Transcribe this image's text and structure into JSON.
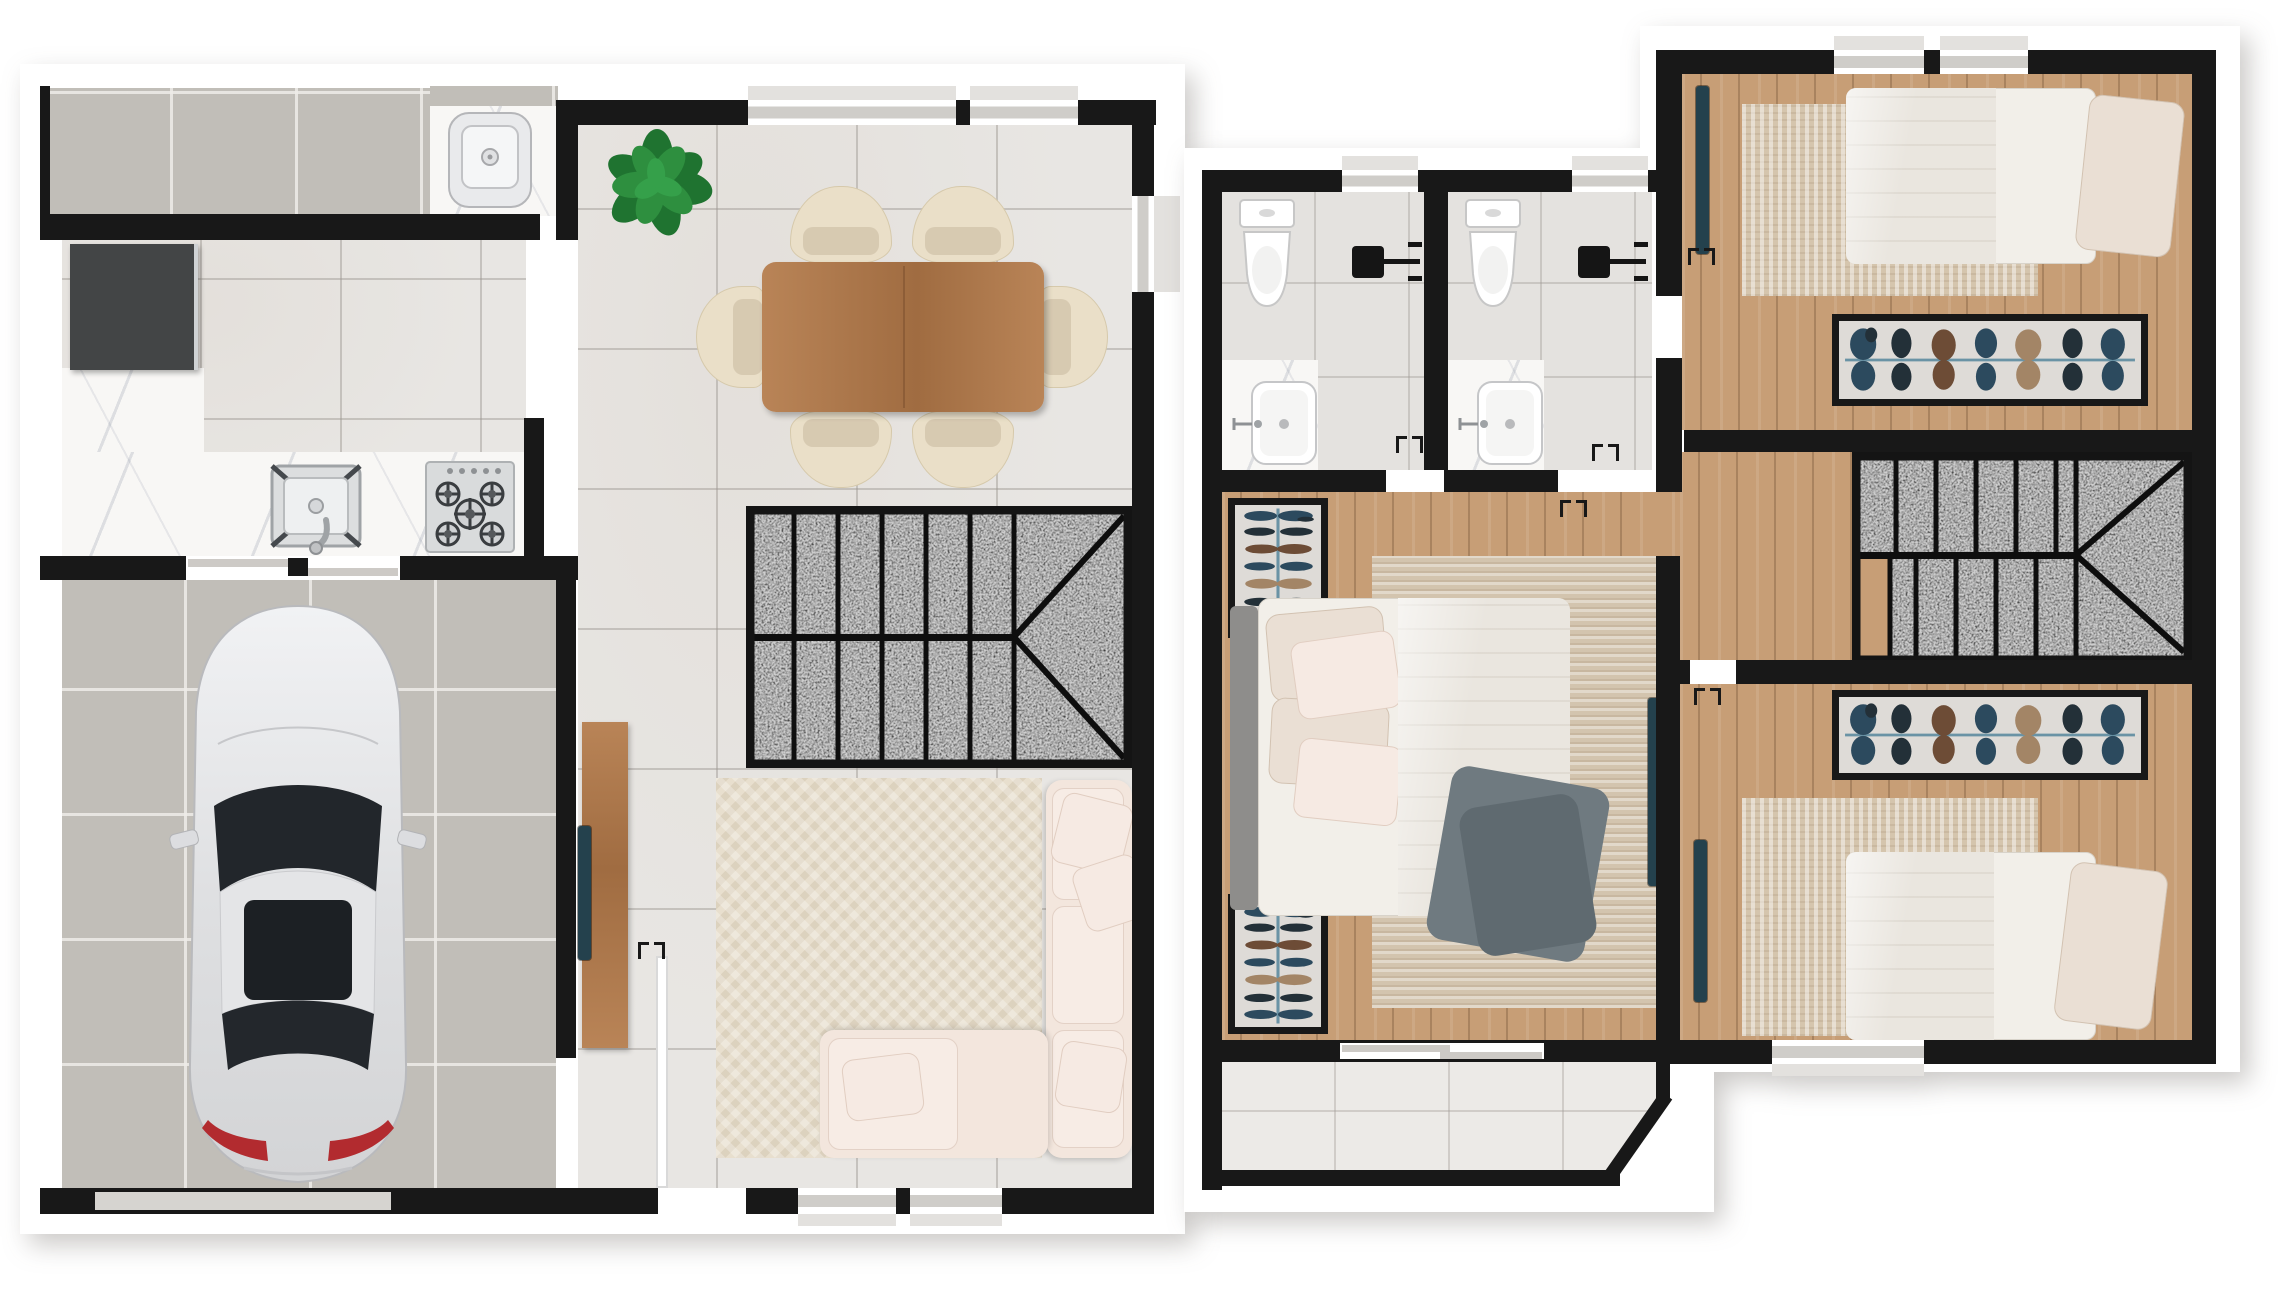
{
  "document": {
    "kind": "architectural floor plan, rendered 3D top view, no text labels",
    "floors_shown": 2
  },
  "palette": {
    "wall": "#181818",
    "sill": "#cfcdc9",
    "floor_tile": "#e8e6e3",
    "concrete": "#c1beb8",
    "wood_floor": "#c79e76",
    "furniture_wood": "#ad7a50",
    "marble": "#f8f7f5",
    "granite": "#3d3d3d",
    "balcony_tile": "#eceae7",
    "rug_living": "#e8dfce",
    "rug_bedroom": "#d5c5ad",
    "sofa": "#f3e6dd",
    "chair": "#eadfc8",
    "linen": "#f2efe9",
    "duvet": "#eae6df",
    "pillow": "#eadfd4",
    "throw": "#6f7a80",
    "headboard": "#8e8d8b",
    "tv": "#24414d",
    "plant_green": "#2e8f3f",
    "steel": "#d8dadb",
    "porcelain": "#ffffff",
    "fixture_black": "#151515",
    "taillight": "#b22b2f",
    "car_body": "#e9eaec",
    "car_glass": "#22262b",
    "rail": "#6a93a5",
    "door_panel": "#cdcac6"
  },
  "plans": [
    {
      "label": "Ground floor",
      "rooms": [
        {
          "label": "Service yard"
        },
        {
          "label": "Kitchen"
        },
        {
          "label": "Garage"
        },
        {
          "label": "Living / dining room"
        },
        {
          "label": "Entry hall"
        },
        {
          "label": "Staircase"
        }
      ],
      "furniture": [
        "laundry-sink",
        "refrigerator",
        "kitchen-sink",
        "gas-cooktop",
        "potted-plant",
        "dining-table",
        "dining-chair x6",
        "staircase",
        "tv-console",
        "television",
        "herringbone-rug",
        "sectional-sofa",
        "pillows",
        "car"
      ]
    },
    {
      "label": "Upper floor",
      "rooms": [
        {
          "label": "Bathroom 1"
        },
        {
          "label": "Bathroom 2"
        },
        {
          "label": "Bedroom 1"
        },
        {
          "label": "Hallway"
        },
        {
          "label": "Staircase"
        },
        {
          "label": "Master bedroom"
        },
        {
          "label": "Bedroom 2"
        },
        {
          "label": "Balcony"
        }
      ],
      "furniture": [
        "toilet x2",
        "washbasin x2",
        "shower-set x2",
        "wardrobe-with-clothes x4",
        "single-bed x2",
        "double-bed",
        "striped-rug x2",
        "lined-rug",
        "television x3",
        "staircase",
        "sliding-balcony-door"
      ]
    }
  ]
}
